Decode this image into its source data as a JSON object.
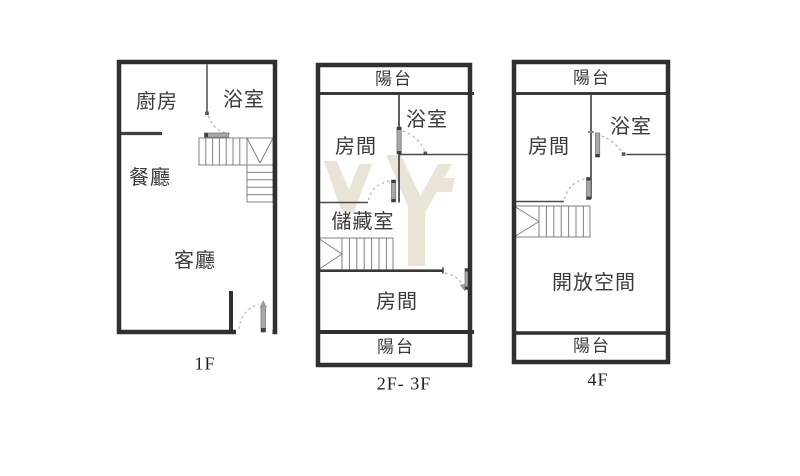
{
  "document": {
    "kind": "floor-plan-set",
    "background": "#ffffff"
  },
  "colors": {
    "outer_wall": "#303030",
    "inner_wall": "#4a4a4a",
    "stair_line": "#808080",
    "door_leaf": "#a8a8a8",
    "door_arc": "#b5b5b5",
    "watermark": "#e9e4d6",
    "label_text": "#3a3a3a"
  },
  "floors": [
    {
      "title": "1F",
      "rooms": {
        "kitchen": "廚房",
        "bathroom": "浴室",
        "dining": "餐廳",
        "living": "客廳"
      }
    },
    {
      "title": "2F- 3F",
      "rooms": {
        "balcony_top": "陽台",
        "bedroom_upper": "房間",
        "bathroom": "浴室",
        "storage": "儲藏室",
        "bedroom_lower": "房間",
        "balcony_bottom": "陽台"
      }
    },
    {
      "title": "4F",
      "rooms": {
        "balcony_top": "陽台",
        "bedroom": "房間",
        "bathroom": "浴室",
        "open_space": "開放空間",
        "balcony_bottom": "陽台"
      }
    }
  ]
}
